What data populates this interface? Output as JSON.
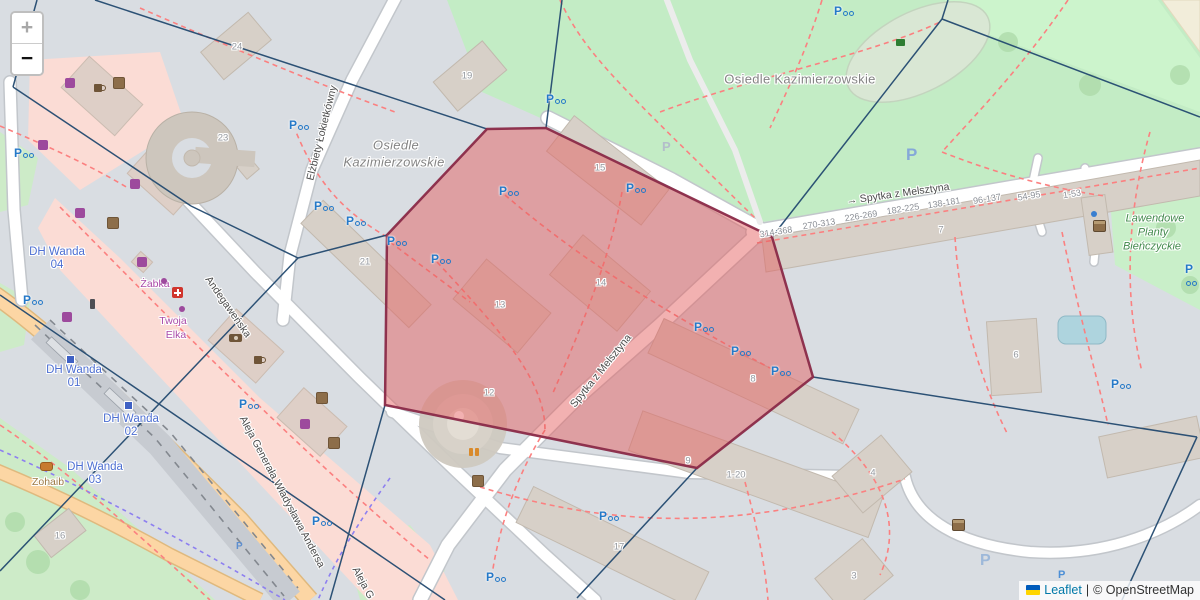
{
  "map": {
    "zoom_control": {
      "zoom_in": "+",
      "zoom_out": "−"
    },
    "attribution": {
      "leaflet_link": "Leaflet",
      "separator": "|",
      "osm_text": "© OpenStreetMap"
    }
  },
  "labels": {
    "neighbourhood_top": "Osiedle Kazimierzowskie",
    "neighbourhood_left_line1": "Osiedle",
    "neighbourhood_left_line2": "Kazimierzowskie",
    "park_line1": "Lawendowe",
    "park_line2": "Planty",
    "park_line3": "Bieńczyckie",
    "street_spytka_arrow": "→",
    "street_spytka_top": "Spytka z Melsztyna",
    "street_spytka_mid": "Spytka z Melsztyna",
    "street_andegawenska": "Andegaweńska",
    "street_lokietkowny": "Elżbiety Łokietkówny",
    "street_aleja": "Aleja Generała Władysława Andersa",
    "street_aleja_short": "Aleja G",
    "shop_zabka": "Żabka",
    "shop_twoja_line1": "Twoja",
    "shop_twoja_line2": "Elka",
    "poi_zohaib": "Zohaib"
  },
  "tram_stops": [
    {
      "name": "DH Wanda",
      "ref": "04"
    },
    {
      "name": "DH Wanda",
      "ref": "01"
    },
    {
      "name": "DH Wanda",
      "ref": "02"
    },
    {
      "name": "DH Wanda",
      "ref": "03"
    }
  ],
  "house_ranges": [
    "314-368",
    "270-313",
    "226-269",
    "182-225",
    "138-181",
    "96-137",
    "54-95",
    "1-53"
  ],
  "building_numbers": {
    "b24": "24",
    "b19": "19",
    "b23": "23",
    "b21": "21",
    "b15": "15",
    "b14": "14",
    "b13": "13",
    "b12": "12",
    "b8": "8",
    "b7": "7",
    "b9": "9",
    "b1_20": "1-20",
    "b17": "17",
    "b4": "4",
    "b3": "3",
    "b6": "6",
    "b16": "16"
  },
  "icons": {
    "parking_letter": "P"
  },
  "colors": {
    "selection_fill": "#e35b5b",
    "selection_stroke": "#8a2a48",
    "voronoi_line": "#234a70",
    "park_green": "#c3ecc5",
    "residential_grey": "#d9dde2",
    "retail_pink": "#fbdcd5",
    "road_orange": "#fcd6a4",
    "parking_blue": "#2579c8"
  }
}
